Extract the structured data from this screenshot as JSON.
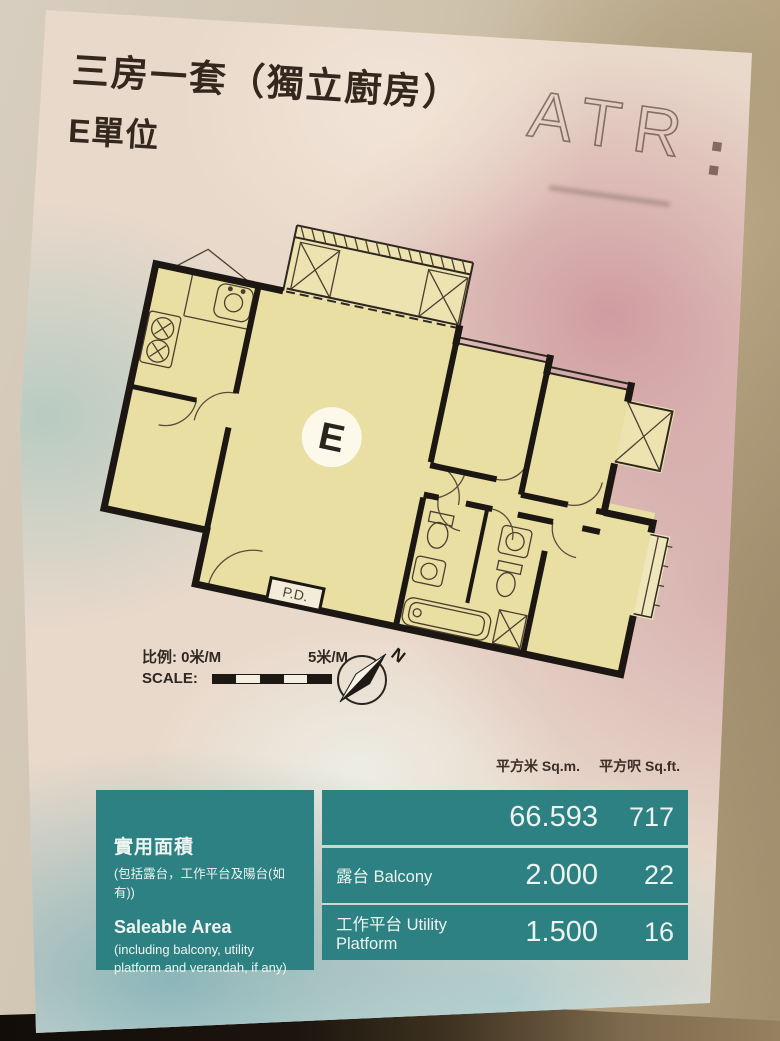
{
  "poster": {
    "title_line1": "三房一套（獨立廚房）",
    "title_line2": "E單位",
    "logo": {
      "text": "ATR"
    },
    "plan": {
      "unit_label": "E",
      "pd_label": "P.D."
    },
    "scale": {
      "zh_label": "比例:",
      "zero_label": "0米/M",
      "five_label": "5米/M",
      "en_label": "SCALE:"
    },
    "compass": {
      "north_label": "N"
    },
    "area_table": {
      "accent_color": "#2e8183",
      "col_headers": {
        "sqm": "平方米 Sq.m.",
        "sqft": "平方呎 Sq.ft."
      },
      "left_cell": {
        "zh_title": "實用面積",
        "zh_note": "(包括露台，工作平台及陽台(如有))",
        "en_title": "Saleable Area",
        "en_note": "(including balcony, utility platform and verandah, if any)"
      },
      "rows": [
        {
          "label": "",
          "sqm": "66.593",
          "sqft": "717"
        },
        {
          "label": "露台 Balcony",
          "sqm": "2.000",
          "sqft": "22"
        },
        {
          "label": "工作平台 Utility Platform",
          "sqm": "1.500",
          "sqft": "16"
        }
      ]
    }
  }
}
